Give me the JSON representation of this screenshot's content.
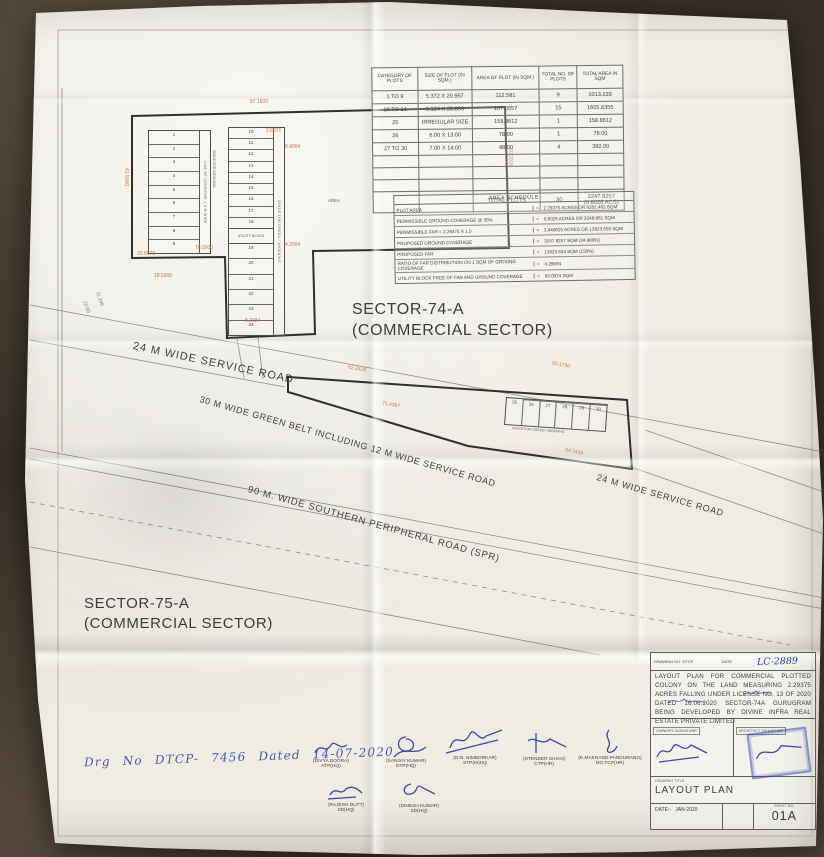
{
  "sheet": {
    "sector74_title": "SECTOR-74-A",
    "sector74_subtitle": "(COMMERCIAL SECTOR)",
    "sector75_title": "SECTOR-75-A",
    "sector75_subtitle": "(COMMERCIAL SECTOR)",
    "roads": {
      "service_left": "24 M WIDE SERVICE ROAD",
      "green_belt": "30 M WIDE GREEN BELT INCLUDING 12 M WIDE SERVICE ROAD",
      "spr": "90 M. WIDE SOUTHERN PERIPHERAL ROAD (SPR)",
      "service_right": "24 M WIDE SERVICE ROAD"
    },
    "handwritten_note": "Drg No DTCP- 7456 Dated 14-07-2020"
  },
  "plot_table": {
    "headers": [
      "CATEGORY OF PLOTS",
      "SIZE OF PLOT (IN SQM.)",
      "AREA OF PLOT (IN SQM.)",
      "TOTAL NO. OF PLOTS",
      "TOTAL AREA IN SQM"
    ],
    "rows": [
      [
        "1 TO 9",
        "5.372 X 20.957",
        "112.581",
        "9",
        "1013.229"
      ],
      [
        "10 TO 24",
        "5.124 X 20.893",
        "107.0557",
        "15",
        "1605.8355"
      ],
      [
        "25",
        "IRREGULAR SIZE",
        "158.8612",
        "1",
        "158.8612"
      ],
      [
        "26",
        "6.00 X 13.00",
        "78.00",
        "1",
        "78.00"
      ],
      [
        "27 TO 30",
        "7.00 X 14.00",
        "98.00",
        "4",
        "392.00"
      ]
    ],
    "total_label": "TOTAL PLOTS",
    "total_plots": "30",
    "total_area_line1": "3247.9257",
    "total_area_line2": "(0.8026 ACS)"
  },
  "area_schedule": {
    "title": "AREA SCHEDULE",
    "eq": "=",
    "rows": [
      {
        "label": "PLOT AREA",
        "value": "2.29375 ACRES OR 9282.462 SQM"
      },
      {
        "label": "PERMISSIBLE GROUND COVERAGE @ 35%",
        "value": "0.8026 ACRES OR 3248.861 SQM"
      },
      {
        "label": "PERMISSIBLE FAR = 2.29375 X 1.5",
        "value": "3.440625 ACRES OR 13923.693 SQM"
      },
      {
        "label": "PROPOSED GROUND COVERAGE",
        "value": "3247.9257 SQM (34.989%)"
      },
      {
        "label": "PROPOSED FAR",
        "value": "13923.693 SQM (150%)"
      },
      {
        "label": "RATIO OF FAR DISTRIBUTION ON 1 SQM OF GROUND COVERAGE",
        "value": "4.28694"
      },
      {
        "label": "UTILITY BLOCK FREE OF FAR AND GROUND COVERAGE",
        "value": "93.0574 SQM"
      }
    ]
  },
  "plan": {
    "dims": [
      "87.1600",
      "2.6071",
      "90.3008",
      "41.5000",
      "20.6070",
      "18.5000",
      "78.5000",
      "8.2684",
      "4.2004",
      "8.4004",
      "62.2618",
      "63.1730",
      "71.4387",
      "64.7439",
      "12.00",
      "11.245"
    ],
    "left_plots": [
      "1",
      "2",
      "3",
      "4",
      "5",
      "6",
      "7",
      "8",
      "9"
    ],
    "middle_plots_top": [
      "10",
      "11",
      "12",
      "13",
      "14",
      "15",
      "16",
      "17",
      "18"
    ],
    "middle_plots_bottom": [
      "19",
      "20",
      "21",
      "22",
      "23",
      "24"
    ],
    "lower_plots": [
      "25",
      "26",
      "27",
      "28",
      "29",
      "30"
    ],
    "utility_block_label": "UTILITY BLOCK",
    "area_label": "AREA",
    "vtexts": {
      "left_sub": "LINE OF CORRIDOR 1.5 M WIDE",
      "corridor": "SPACE FOR WIDENING",
      "middle_sub": "SPACE FOR GREEN / WIDENING",
      "lower_strip": "SPACE FOR GREEN / WIDENING"
    }
  },
  "signatures": {
    "row1": [
      {
        "name": "(DIVYA DOGRA)",
        "title": "ATP(HQ)"
      },
      {
        "name": "(SANJAY KUMAR)",
        "title": "DTP(HQ)"
      },
      {
        "name": "(D.N. NIMBORKAR)",
        "title": "STP(M)HQ"
      },
      {
        "name": "(JITENDER SIHAG)",
        "title": "CTP(HR)"
      },
      {
        "name": "(K.MAKRAND PANDURANG)",
        "title": "DG,TCP(HR)"
      }
    ],
    "row2": [
      {
        "name": "(RAJESH DUTT)",
        "title": "SD(HQ)"
      },
      {
        "name": "(DINESH KUMAR)",
        "title": "SD(HQ)"
      }
    ]
  },
  "title_block": {
    "drawing_no_label": "DRAWING NO. DTCP",
    "date_label": "DATE",
    "handwritten_no": "LC-2889",
    "description": "LAYOUT PLAN FOR COMMERCIAL PLOTTED COLONY ON THE LAND MEASURING 2.29375 ACRES FALLING UNDER LICENSE NO. 13 OF 2020 DATED 16.06.2020 SECTOR-74A GURUGRAM BEING DEVELOPED BY DIVINE INFRA REAL ESTATE PRIVATE LIMITED",
    "owner_sig_label": "OWNER'S SIGNATURE",
    "architect_sig_label": "ARCHITECT SIGNATURE",
    "drawing_title_label": "DRAWING TITLE",
    "drawing_title": "LAYOUT PLAN",
    "date_field_label": "DATE:-",
    "date_value": "JAN-2020",
    "sheet_label": "SHEET NO.",
    "sheet_number": "01A"
  },
  "colors": {
    "ink_blue": "#2c3e9e",
    "dimension_orange": "#c4764a",
    "paper": "#efece4",
    "line_dark": "#2f2f2f"
  }
}
